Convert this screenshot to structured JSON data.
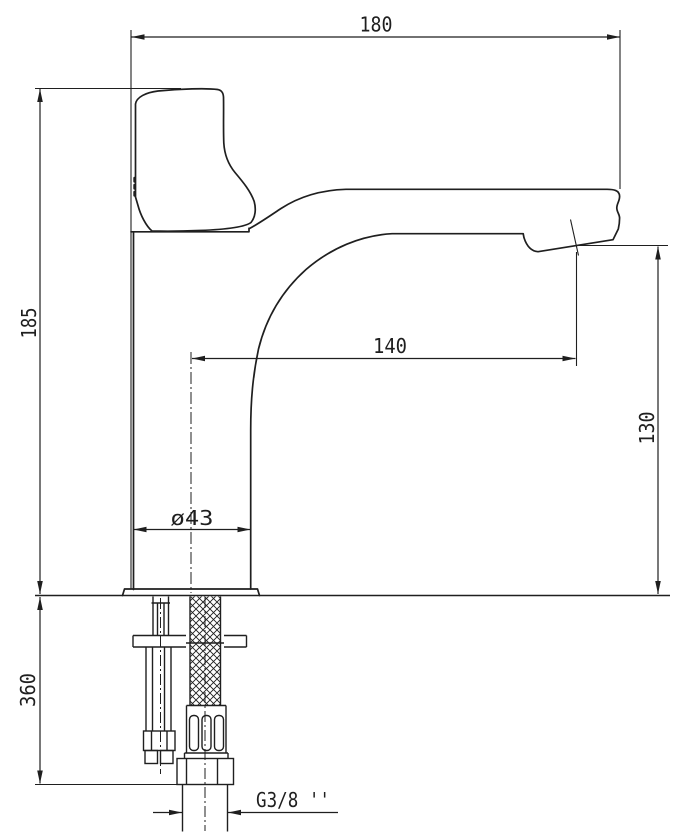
{
  "drawing": {
    "type": "technical-dimension-drawing",
    "subject": "single-lever basin faucet, side view with below-deck mounting stud and supply hose",
    "background_color": "#ffffff",
    "line_color": "#1f1f1f",
    "labels": {
      "overall_length": "180",
      "body_height": "185",
      "spout_reach": "140",
      "outlet_height": "130",
      "base_diameter": "ø43",
      "below_deck_length": "360",
      "thread_size": "G3/8 ''"
    }
  }
}
